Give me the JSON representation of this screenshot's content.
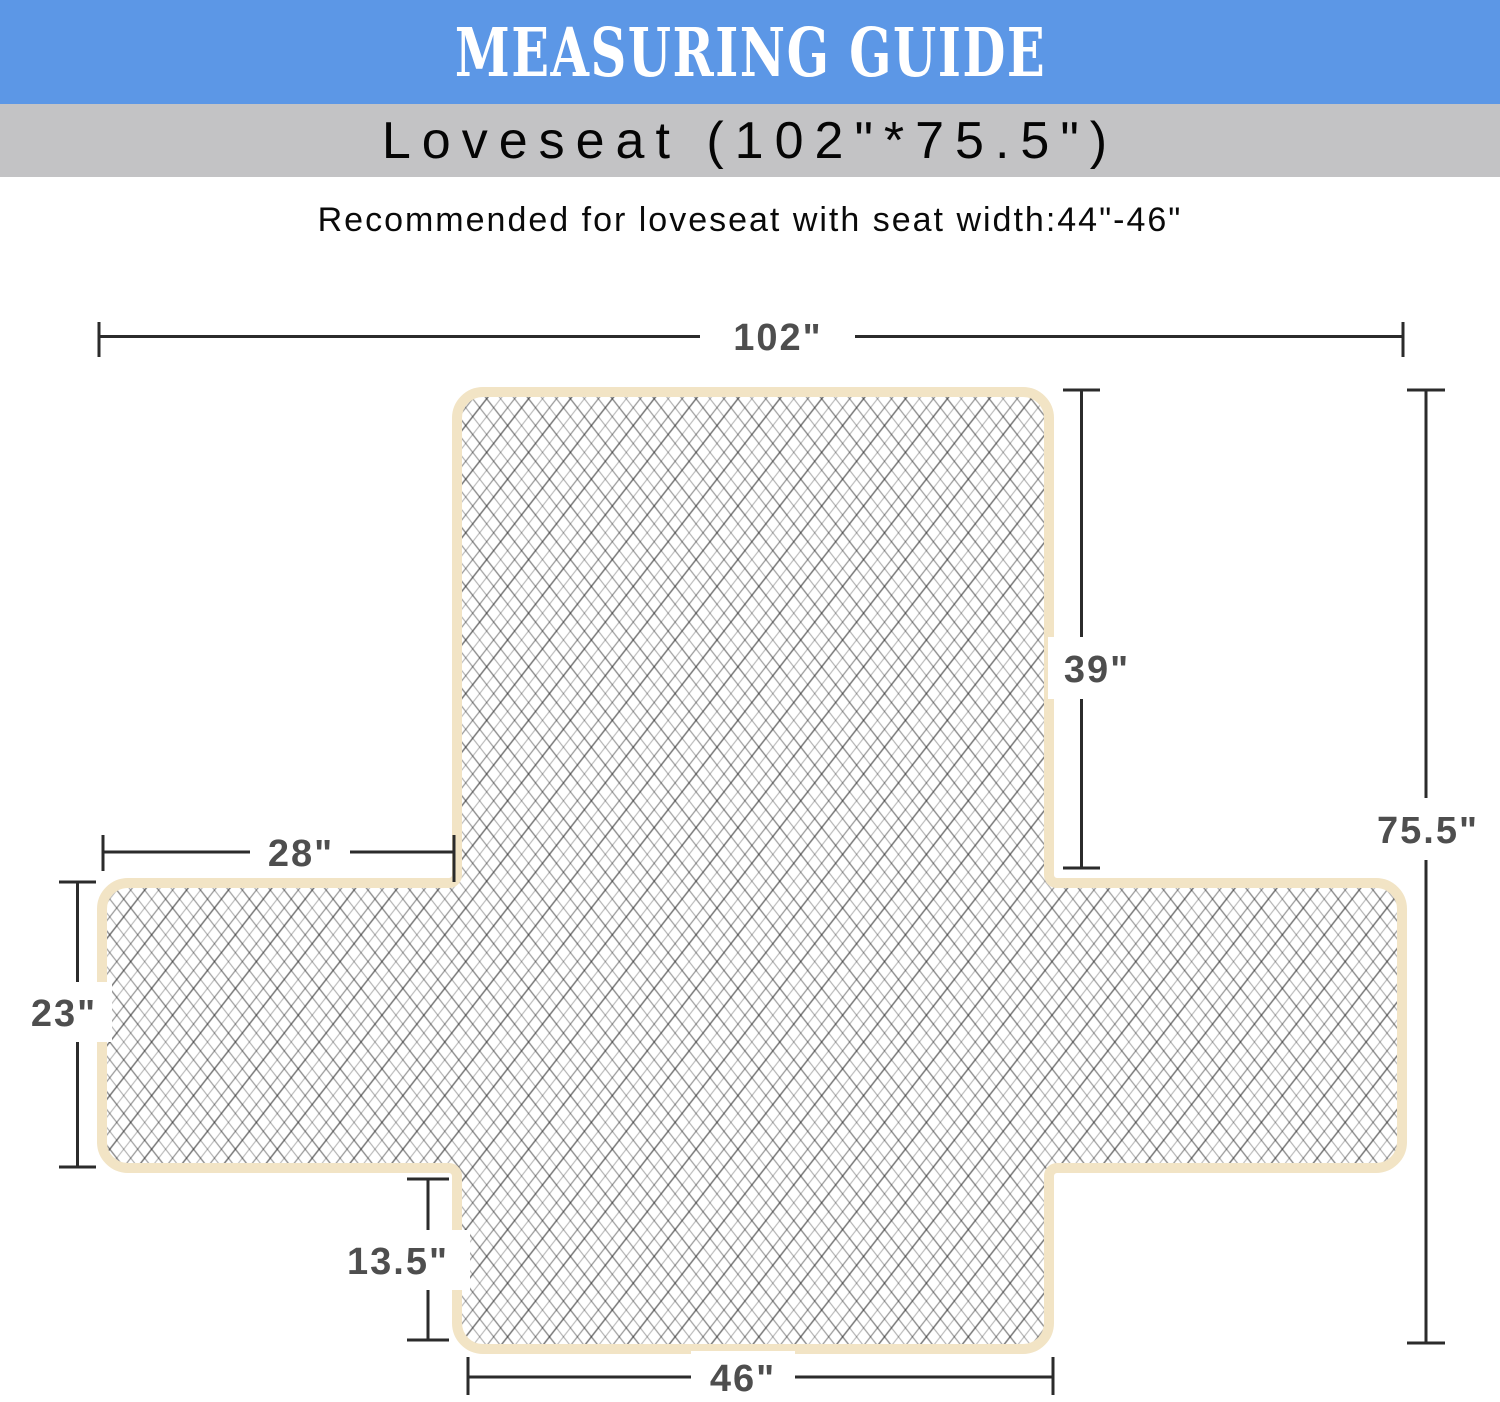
{
  "header": {
    "label": "MEASURING GUIDE",
    "background": "#5C97E6",
    "text_color": "#ffffff"
  },
  "subheader": {
    "label": "Loveseat (102\"*75.5\")",
    "background": "#C3C3C5",
    "text_color": "#050505"
  },
  "note": {
    "label": "Recommended for loveseat with seat width:44\"-46\""
  },
  "diagram": {
    "shape": "loveseat-cover-laid-flat-cross",
    "cover_edge_color": "#F2E4C5",
    "hatch_line_color": "#222222",
    "dimension_line_color": "#2b2b2b",
    "dimension_label_color": "#4e4e4e",
    "dimensions": {
      "total_width": "102\"",
      "back_height": "39\"",
      "total_length": "75.5\"",
      "arm_flap_width": "28\"",
      "arm_flap_height": "23\"",
      "front_drop": "13.5\"",
      "seat_front_width": "46\""
    }
  }
}
